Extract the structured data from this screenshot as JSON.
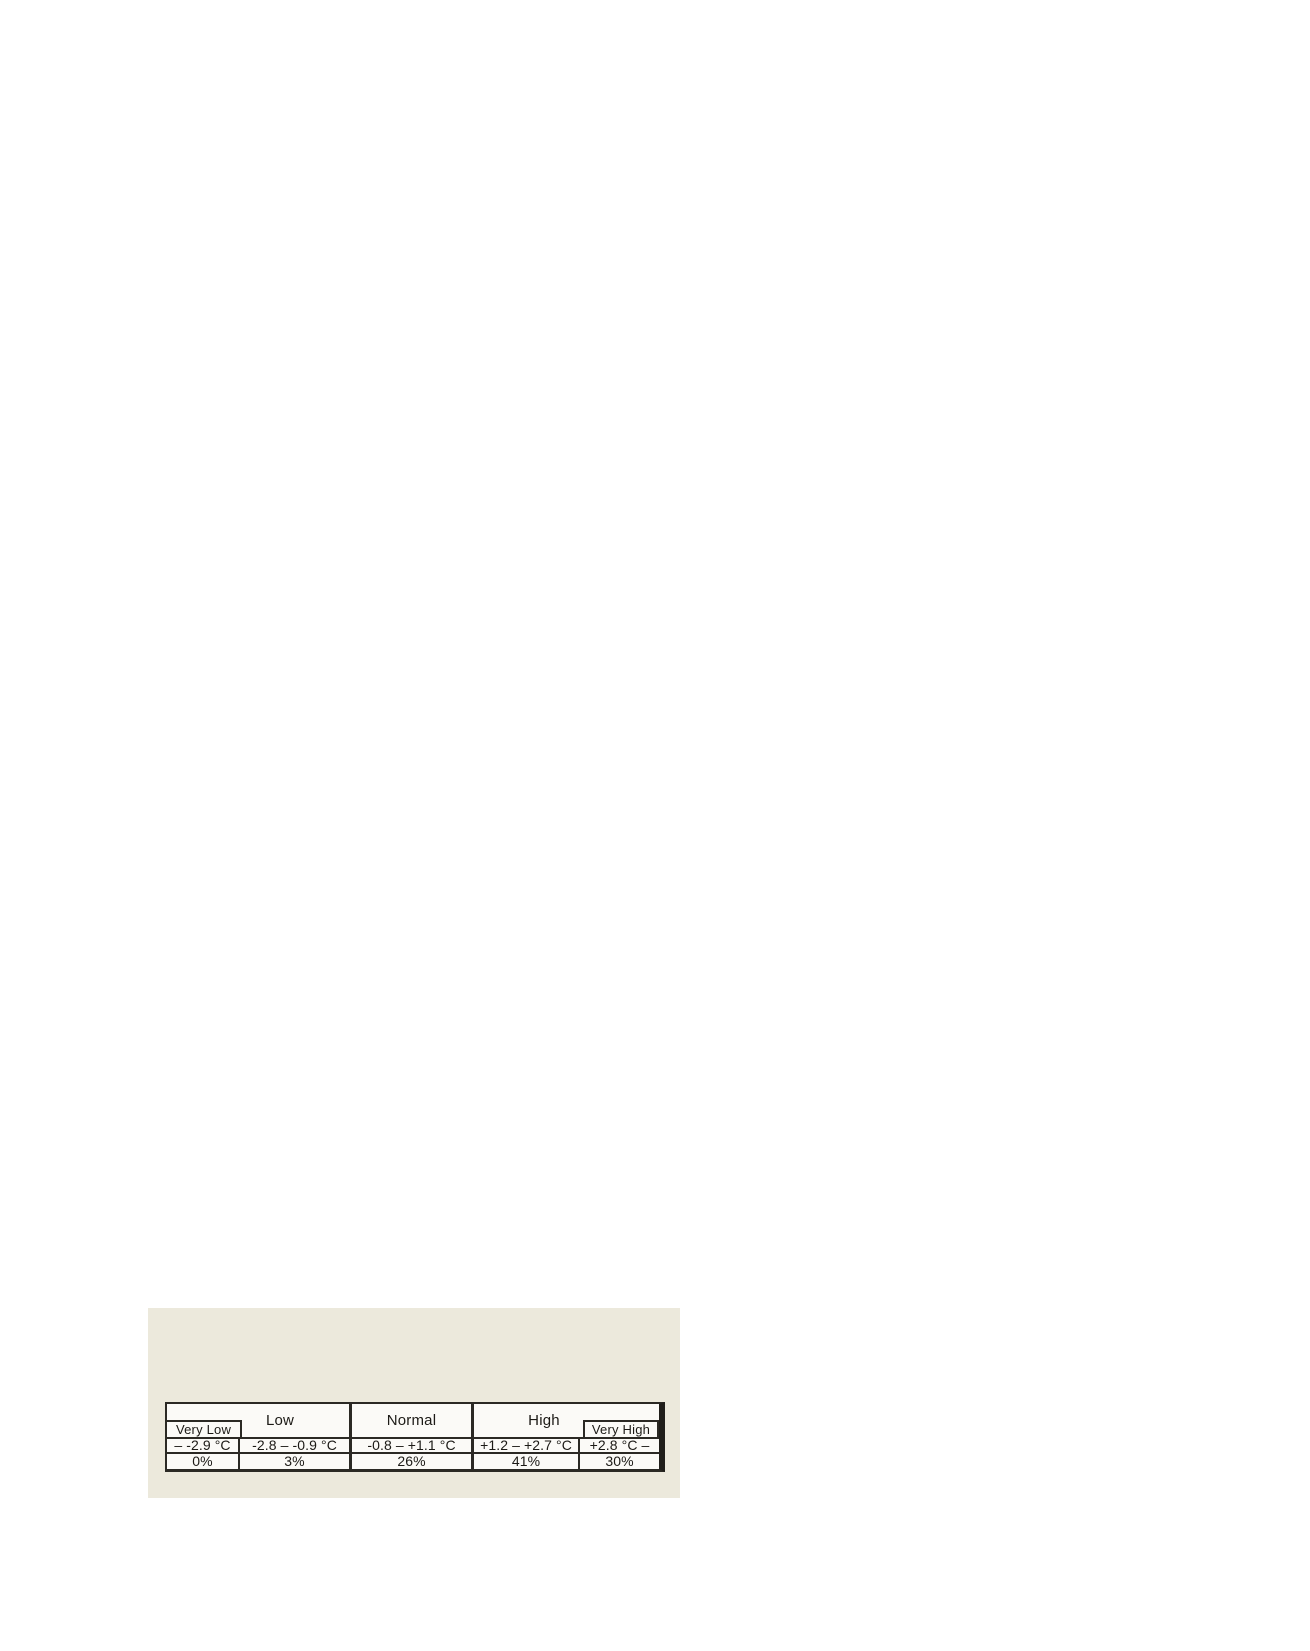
{
  "figure": {
    "labels": {
      "very_low": "Very Low",
      "low": "Low",
      "normal": "Normal",
      "high": "High",
      "very_high": "Very High"
    },
    "ranges": {
      "very_low": "– -2.9 °C",
      "low": "-2.8 – -0.9 °C",
      "normal": "-0.8 – +1.1 °C",
      "high": "+1.2 – +2.7 °C",
      "very_high": "+2.8 °C –"
    },
    "percentages": {
      "very_low": "0%",
      "low": "3%",
      "normal": "26%",
      "high": "41%",
      "very_high": "30%"
    },
    "colors": {
      "panel_background": "#ece9dc",
      "cell_background": "#fbfaf7",
      "border": "#2b2924",
      "border_dark": "#201e1a",
      "text": "#1c1a16"
    }
  },
  "chart_data": {
    "type": "table",
    "categories": [
      "Very Low",
      "Low",
      "Normal",
      "High",
      "Very High"
    ],
    "rows": [
      {
        "name": "temperature_range_celsius",
        "values": [
          "– -2.9 °C",
          "-2.8 – -0.9 °C",
          "-0.8 – +1.1 °C",
          "+1.2 – +2.7 °C",
          "+2.8 °C –"
        ]
      },
      {
        "name": "probability_percent",
        "values": [
          "0%",
          "3%",
          "26%",
          "41%",
          "30%"
        ]
      }
    ],
    "probabilities_percent_numeric": [
      0,
      3,
      26,
      41,
      30
    ]
  }
}
